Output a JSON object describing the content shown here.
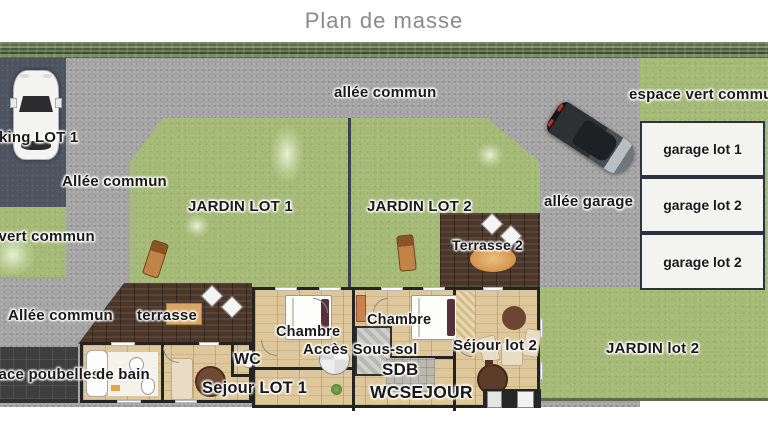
{
  "title": "Plan de masse",
  "site": {
    "common_areas": {
      "allee_commun_top": "allée commun",
      "allee_commun_left_upper": "Allée commun",
      "allee_commun_left_lower": "Allée commun",
      "espace_vert_commun_right": "espace vert commun",
      "espace_vert_commun_left": "espace vert commun",
      "allee_garage": "allée garage",
      "espace_poubelles": "espace poubelles",
      "parking_lot1": "parking LOT 1"
    },
    "gardens": {
      "jardin_lot1": "JARDIN LOT 1",
      "jardin_lot2_upper": "JARDIN LOT 2",
      "jardin_lot2_lower": "JARDIN lot 2"
    },
    "garages": [
      {
        "label": "garage lot 1"
      },
      {
        "label": "garage lot 2"
      },
      {
        "label": "garage lot 2"
      }
    ],
    "house": {
      "terrasse_lot1": "terrasse",
      "terrasse_lot2": "Terrasse 2",
      "chambre_left": "Chambre",
      "chambre_right": "Chambre",
      "acces_sous_sol": "Accès Sous-sol",
      "salle_de_bain_visible": "de bain",
      "wc_upper": "WC",
      "sdb": "SDB",
      "wc_lower": "WC",
      "sejour_lower": "SEJOUR",
      "sejour_lot1": "Sejour LOT 1",
      "sejour_lot2": "Séjour lot 2"
    }
  },
  "colors": {
    "grass": "#a6ba77",
    "road": "#a3a3a3",
    "parking_dark": "#4d5460",
    "wood_floor": "#ddc79b",
    "terrace_wood": "#4a3729",
    "wall": "#232323",
    "garage_fill": "#f3f3ef",
    "label_text": "#191919",
    "title_gray": "#8a8a8a"
  }
}
